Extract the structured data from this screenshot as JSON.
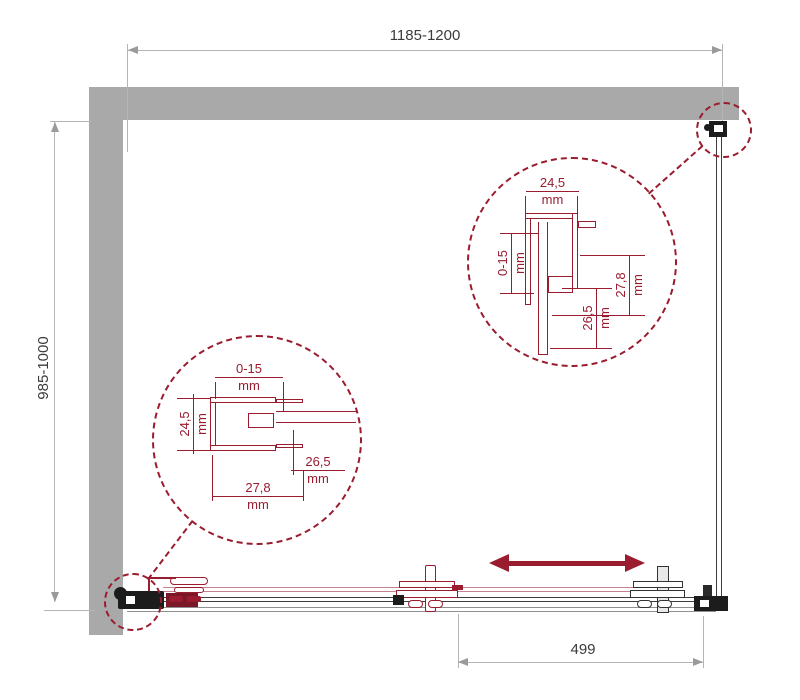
{
  "drawing": {
    "type": "shower-enclosure-plan-technical-drawing",
    "unit": "mm"
  },
  "dimensions": {
    "width": {
      "value": "1185-1200"
    },
    "depth": {
      "value": "985-1000"
    },
    "door": {
      "value": "499"
    }
  },
  "details": {
    "top_right": {
      "profile_width": {
        "value": "24,5",
        "unit": "mm"
      },
      "adjustment": {
        "value": "0-15",
        "unit": "mm"
      },
      "profile_depth": {
        "value": "27,8",
        "unit": "mm"
      },
      "inner_depth": {
        "value": "26,5",
        "unit": "mm"
      }
    },
    "left": {
      "adjustment": {
        "value": "0-15",
        "unit": "mm"
      },
      "profile_width": {
        "value": "24,5",
        "unit": "mm"
      },
      "inner_depth": {
        "value": "26,5",
        "unit": "mm"
      },
      "profile_depth": {
        "value": "27,8",
        "unit": "mm"
      }
    }
  },
  "colors": {
    "accent": "#9a1c2f",
    "accent_light": "#c4838f",
    "wall_gray": "#a9a9a9",
    "dimension_line": "#b5b5b5",
    "dimension_text": "#3b3b3b",
    "track_dark": "#3d3d3d",
    "track_gray": "#8f8f8f"
  }
}
